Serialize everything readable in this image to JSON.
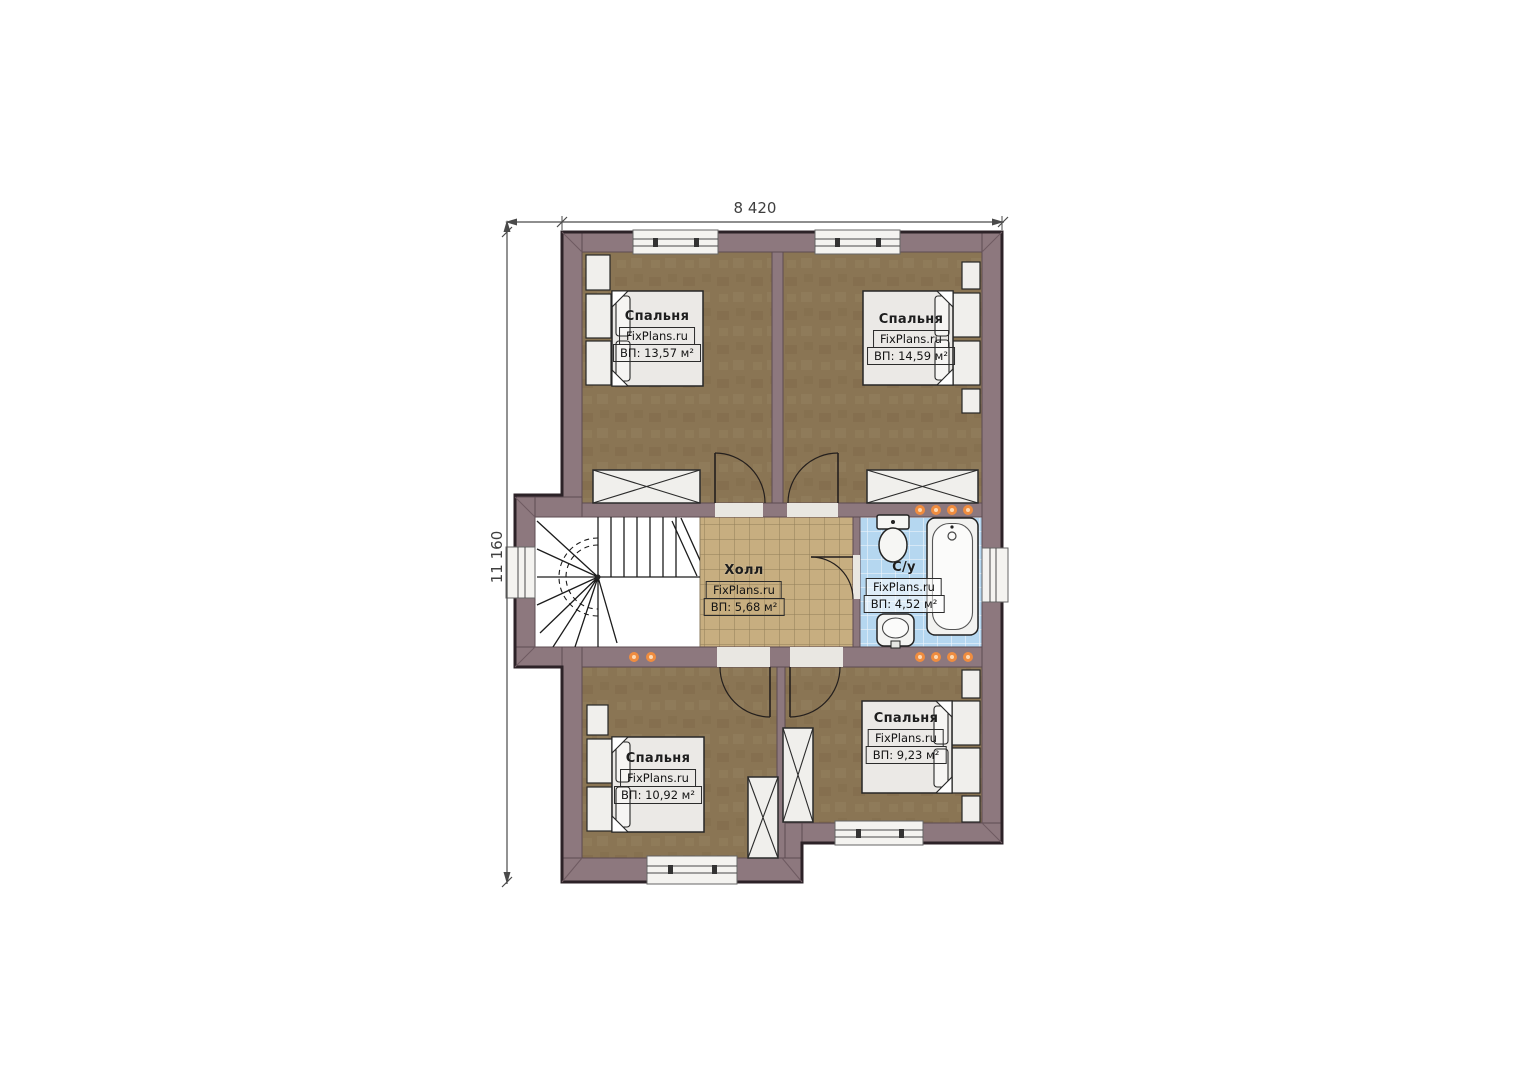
{
  "plan": {
    "type": "floor-plan",
    "storey": "second floor with stair, hall, bathroom and four bedrooms"
  },
  "dimensions": {
    "width_label": "8 420",
    "height_label": "11 160"
  },
  "rooms": [
    {
      "id": "bedroom-top-left",
      "name": "Спальня",
      "brand": "FixPlans.ru",
      "area": "ВП: 13,57 м²"
    },
    {
      "id": "bedroom-top-right",
      "name": "Спальня",
      "brand": "FixPlans.ru",
      "area": "ВП: 14,59 м²"
    },
    {
      "id": "hall",
      "name": "Холл",
      "brand": "FixPlans.ru",
      "area": "ВП: 5,68 м²"
    },
    {
      "id": "bathroom",
      "name": "С/у",
      "brand": "FixPlans.ru",
      "area": "ВП: 4,52 м²"
    },
    {
      "id": "bedroom-bottom-left",
      "name": "Спальня",
      "brand": "FixPlans.ru",
      "area": "ВП: 10,92 м²"
    },
    {
      "id": "bedroom-bottom-right",
      "name": "Спальня",
      "brand": "FixPlans.ru",
      "area": "ВП: 9,23 м²"
    }
  ],
  "colors": {
    "wall": "#8d787e",
    "outline": "#2c2227",
    "bedroom_floor": "#8a7554",
    "hall_floor": "#c7ae80",
    "bathroom_floor": "#b5d7f0",
    "furniture": "#ebe9e6",
    "accent_dots": "#ef8c3f",
    "dimension": "#4a4a4a",
    "background": "#ffffff"
  }
}
